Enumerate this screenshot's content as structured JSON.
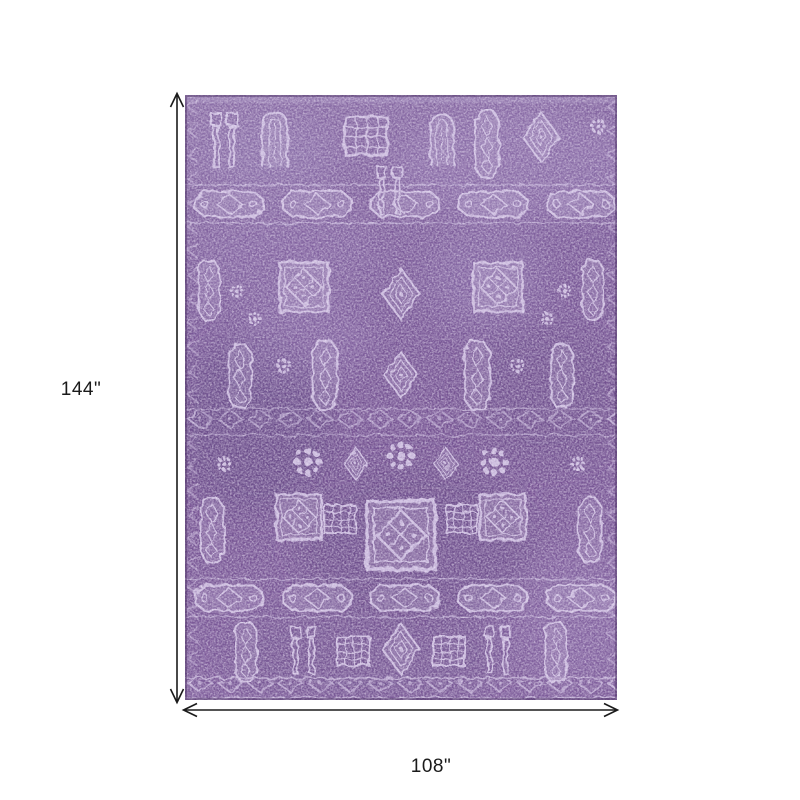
{
  "figure": {
    "name": "purple-distressed-oriental-rug"
  },
  "dimensions": {
    "height_label": "144\"",
    "width_label": "108\""
  },
  "colors": {
    "canvas_background": "#ffffff",
    "dimension_line": "#1a1a1a",
    "label_text": "#1a1a1a",
    "rug_field_purple": "#7b5b99",
    "rug_shadow_purple": "#5e4278",
    "rug_motif_lavender": "#d6c8e8",
    "rug_highlight": "#e6dcf2"
  }
}
